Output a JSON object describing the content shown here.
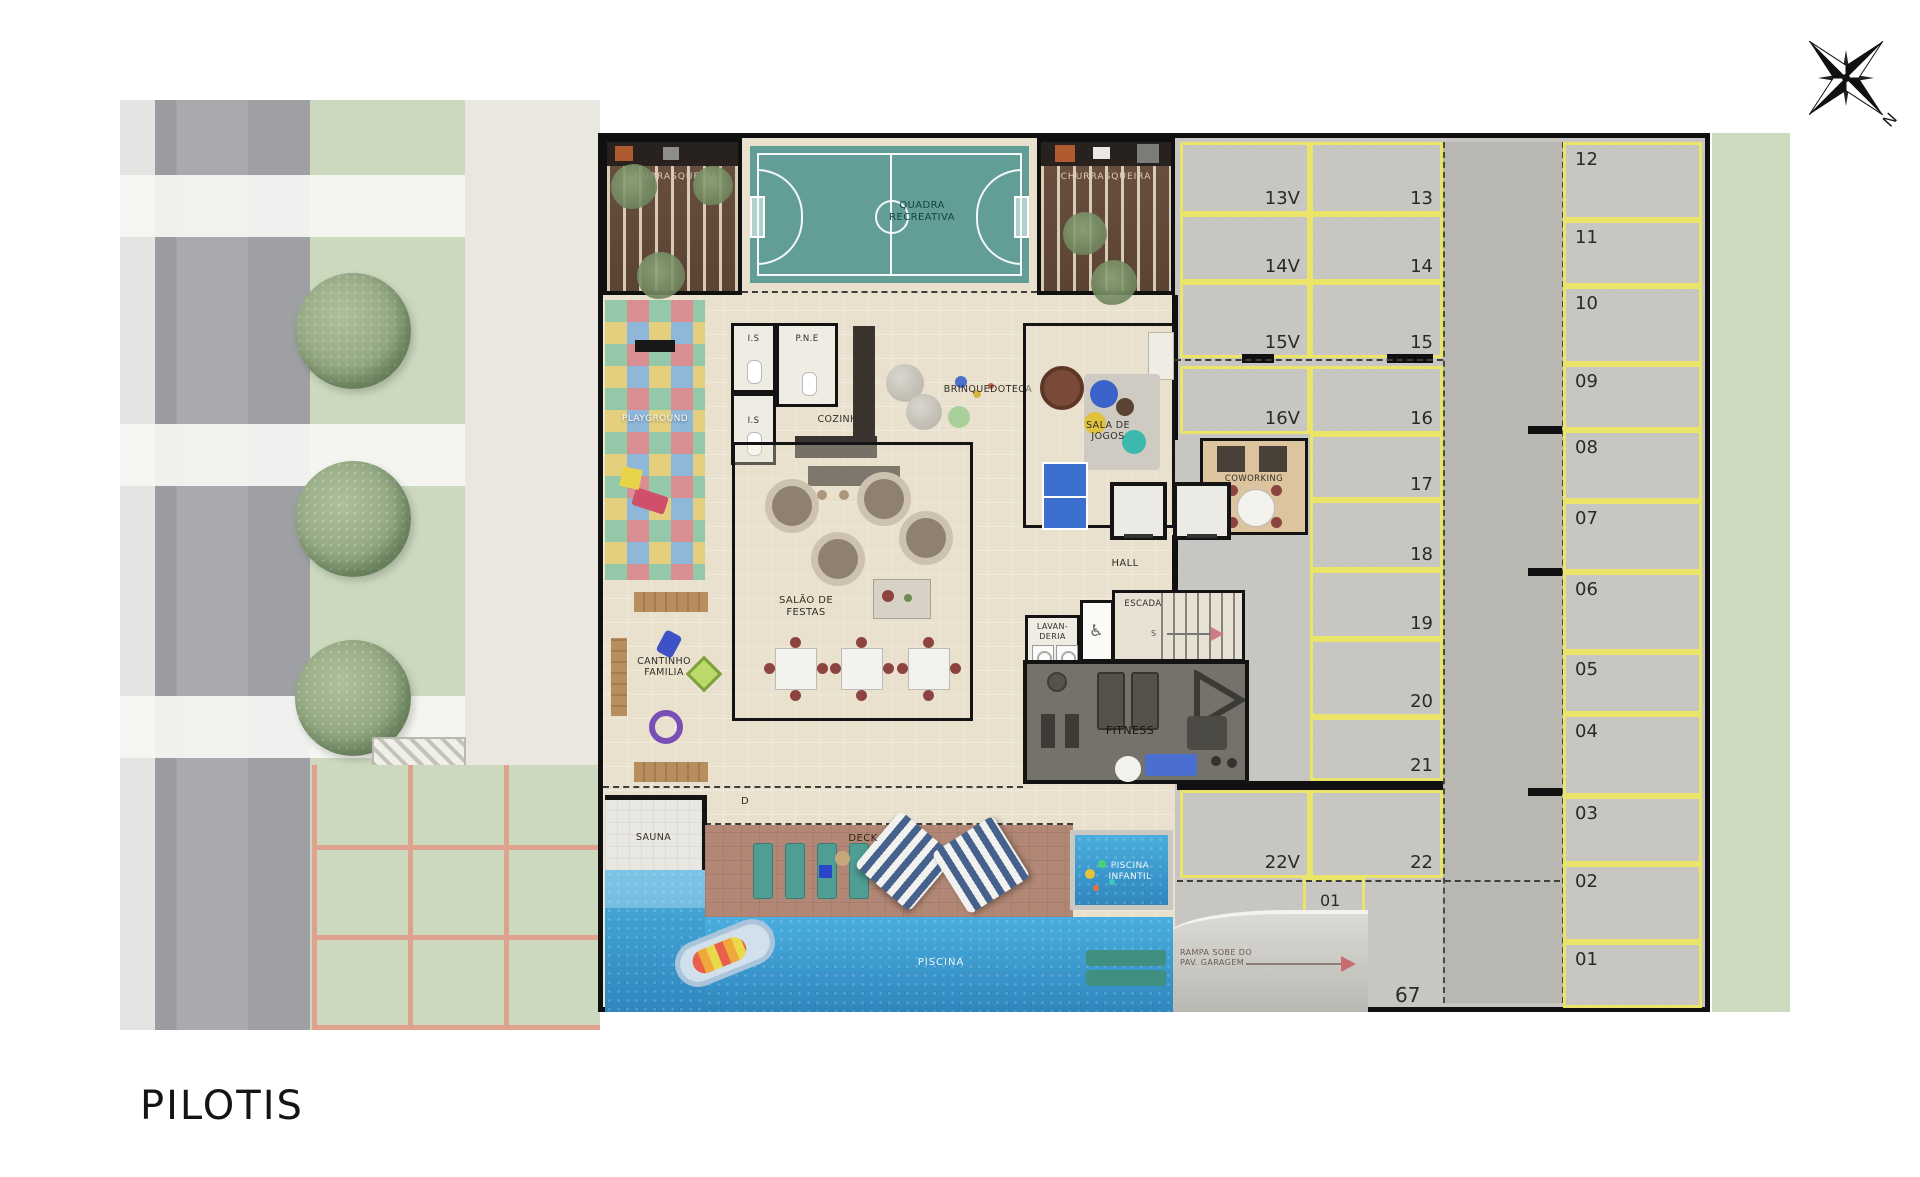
{
  "title": "PILOTIS",
  "compass": {
    "north": "N"
  },
  "colors": {
    "court": "#629e97",
    "pool": "#3b9fd4",
    "stall_line": "#eae468",
    "deck": "#b28775",
    "grass": "#ccd9bf"
  },
  "rooms": {
    "churrasqueira_left": "CHURRASQUEIRA",
    "churrasqueira_right": "CHURRASQUEIRA",
    "quadra_line1": "QUADRA",
    "quadra_line2": "RECREATIVA",
    "playground": "PLAYGROUND",
    "is_top": "I.S",
    "pne": "P.N.E",
    "is_bottom": "I.S",
    "cozinha": "COZINHA",
    "brinquedoteca": "BRINQUEDOTECA",
    "sala_de_jogos_line1": "SALA DE",
    "sala_de_jogos_line2": "JOGOS",
    "coworking": "COWORKING",
    "hall": "HALL",
    "escada": "ESCADA",
    "escada_s": "S",
    "lavanderia_line1": "LAVAN-",
    "lavanderia_line2": "DERIA",
    "fitness": "FITNESS",
    "salao_line1": "SALÃO DE",
    "salao_line2": "FESTAS",
    "cantinho_line1": "CANTINHO",
    "cantinho_line2": "FAMILIA",
    "sauna": "SAUNA",
    "deck": "DECK",
    "d_marker": "D",
    "piscina": "PISCINA",
    "piscina_infantil_line1": "PISCINA",
    "piscina_infantil_line2": "INFANTIL"
  },
  "parking": {
    "visitor_column": [
      "13V",
      "14V",
      "15V",
      "16V"
    ],
    "middle_column": [
      "13",
      "14",
      "15",
      "16",
      "17",
      "18",
      "19",
      "20",
      "21"
    ],
    "right_column": [
      "12",
      "11",
      "10",
      "09",
      "08",
      "07",
      "06",
      "05",
      "04",
      "03",
      "02",
      "01"
    ],
    "bottom_row": [
      "22V",
      "22"
    ],
    "stall_01_small": "01",
    "stall_67": "67",
    "ramp_label_line1": "RAMPA SOBE DO",
    "ramp_label_line2": "PAV. GARAGEM"
  }
}
